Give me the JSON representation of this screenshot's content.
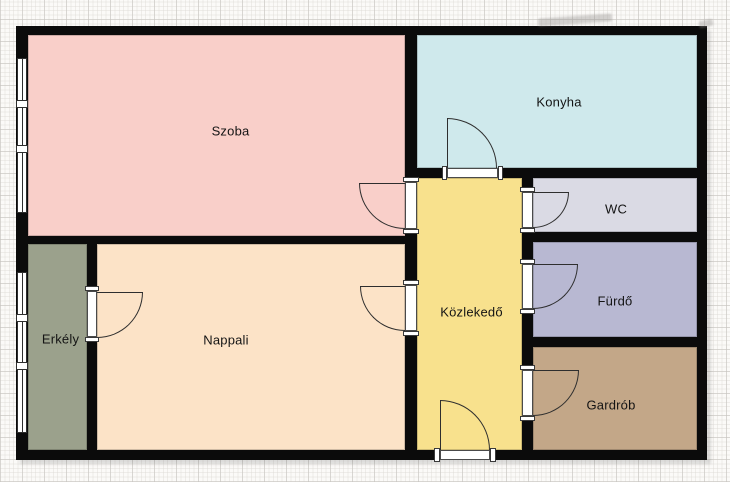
{
  "title": "apartment-floorplan",
  "canvas": {
    "width": 730,
    "height": 482,
    "paper_color": "#fbfaf8",
    "grid_minor_color": "#ddd9d5",
    "grid_major_color": "#c6c3bf"
  },
  "plan": {
    "x": 16,
    "y": 26,
    "width": 691,
    "height": 434,
    "wall_color": "#0b0b0b",
    "line_color": "#2e2e2e",
    "frame_color": "#ffffff"
  },
  "rooms": [
    {
      "id": "szoba",
      "label": "Szoba",
      "color": "#f9cfc9",
      "x": 12,
      "y": 9,
      "w": 377,
      "h": 201,
      "dx": 14,
      "dy": -5
    },
    {
      "id": "konyha",
      "label": "Konyha",
      "color": "#cfe9ec",
      "x": 401,
      "y": 9,
      "w": 280,
      "h": 133,
      "dx": 2,
      "dy": 0
    },
    {
      "id": "wc",
      "label": "WC",
      "color": "#dadae4",
      "x": 517,
      "y": 152,
      "w": 164,
      "h": 54,
      "dx": 1,
      "dy": 4
    },
    {
      "id": "furdo",
      "label": "Fürdő",
      "color": "#b8b8d2",
      "x": 517,
      "y": 216,
      "w": 164,
      "h": 95,
      "dx": 0,
      "dy": 11
    },
    {
      "id": "gardrob",
      "label": "Gardrób",
      "color": "#c3a788",
      "x": 517,
      "y": 321,
      "w": 164,
      "h": 103,
      "dx": -4,
      "dy": 6
    },
    {
      "id": "kozlekedo",
      "label": "Közlekedő",
      "color": "#f8e18d",
      "x": 401,
      "y": 152,
      "w": 105,
      "h": 272,
      "dx": 2,
      "dy": -2
    },
    {
      "id": "nappali",
      "label": "Nappali",
      "color": "#fce3c7",
      "x": 81,
      "y": 218,
      "w": 308,
      "h": 206,
      "dx": -25,
      "dy": -7
    },
    {
      "id": "erkely",
      "label": "Erkély",
      "color": "#9ba18c",
      "x": 12,
      "y": 218,
      "w": 59,
      "h": 206,
      "dx": 3,
      "dy": -8
    }
  ],
  "windows": [
    {
      "id": "szoba-window",
      "frame": [
        1,
        32,
        10,
        155
      ],
      "mullions": [
        [
          0,
          74,
          12,
          8
        ],
        [
          0,
          119,
          12,
          8
        ]
      ]
    },
    {
      "id": "erkely-window",
      "frame": [
        1,
        246,
        10,
        161
      ],
      "mullions": [
        [
          0,
          288,
          12,
          8
        ],
        [
          0,
          336,
          12,
          8
        ]
      ]
    }
  ],
  "doors": [
    {
      "id": "szoba-door",
      "opening": [
        389,
        156,
        12,
        47
      ],
      "jambs": [
        [
          387,
          151,
          16,
          5
        ],
        [
          387,
          203,
          16,
          5
        ]
      ],
      "leaf": [
        343,
        157,
        46,
        1
      ],
      "arc": [
        343,
        157,
        46,
        46
      ],
      "corner": "bl"
    },
    {
      "id": "nappali-door",
      "opening": [
        389,
        259,
        12,
        46
      ],
      "jambs": [
        [
          387,
          254,
          16,
          5
        ],
        [
          387,
          305,
          16,
          5
        ]
      ],
      "leaf": [
        344,
        260,
        45,
        1
      ],
      "arc": [
        344,
        260,
        45,
        45
      ],
      "corner": "bl"
    },
    {
      "id": "erkely-door",
      "opening": [
        71,
        265,
        10,
        46
      ],
      "jambs": [
        [
          69,
          260,
          14,
          5
        ],
        [
          69,
          311,
          14,
          5
        ]
      ],
      "leaf": [
        81,
        266,
        46,
        1
      ],
      "arc": [
        81,
        266,
        46,
        46
      ],
      "corner": "br"
    },
    {
      "id": "konyha-door",
      "opening": [
        431,
        142,
        51,
        10
      ],
      "jambs": [
        [
          426,
          140,
          5,
          14
        ],
        [
          482,
          140,
          5,
          14
        ]
      ],
      "leaf": [
        431,
        92,
        1,
        50
      ],
      "arc": [
        431,
        92,
        50,
        50
      ],
      "corner": "tr"
    },
    {
      "id": "wc-door",
      "opening": [
        506,
        166,
        11,
        36
      ],
      "jambs": [
        [
          504,
          161,
          15,
          5
        ],
        [
          504,
          202,
          15,
          5
        ]
      ],
      "leaf": [
        517,
        166,
        36,
        1
      ],
      "arc": [
        517,
        166,
        36,
        36
      ],
      "corner": "br"
    },
    {
      "id": "furdo-door",
      "opening": [
        506,
        238,
        11,
        45
      ],
      "jambs": [
        [
          504,
          233,
          15,
          5
        ],
        [
          504,
          283,
          15,
          5
        ]
      ],
      "leaf": [
        517,
        238,
        45,
        1
      ],
      "arc": [
        517,
        238,
        45,
        45
      ],
      "corner": "br"
    },
    {
      "id": "gardrob-door",
      "opening": [
        506,
        344,
        11,
        46
      ],
      "jambs": [
        [
          504,
          339,
          15,
          5
        ],
        [
          504,
          390,
          15,
          5
        ]
      ],
      "leaf": [
        517,
        344,
        46,
        1
      ],
      "arc": [
        517,
        344,
        46,
        46
      ],
      "corner": "br"
    },
    {
      "id": "entrance-door",
      "opening": [
        424,
        424,
        50,
        10
      ],
      "jambs": [
        [
          418,
          422,
          6,
          14
        ],
        [
          474,
          422,
          6,
          14
        ]
      ],
      "leaf": [
        424,
        374,
        1,
        50
      ],
      "arc": [
        424,
        374,
        50,
        50
      ],
      "corner": "tr"
    }
  ],
  "smudges": [
    {
      "x": 538,
      "y": 16,
      "w": 74,
      "h": 8,
      "rot": -4
    },
    {
      "x": 699,
      "y": 20,
      "w": 14,
      "h": 7,
      "rot": -12
    }
  ]
}
